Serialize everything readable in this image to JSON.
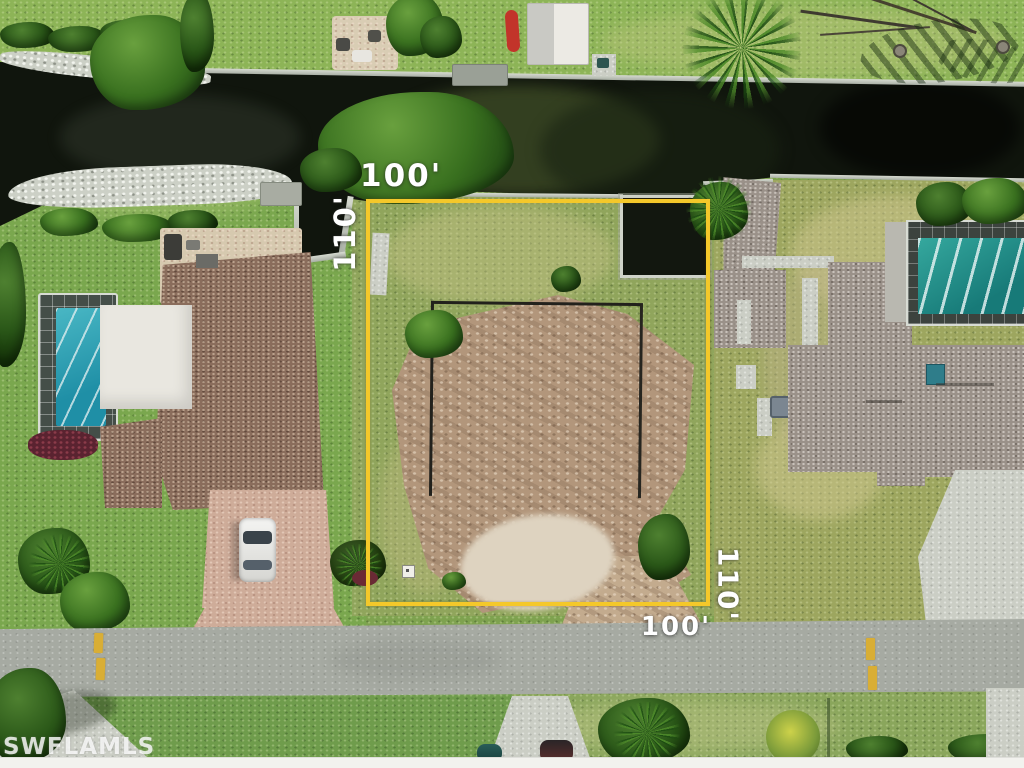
{
  "photo": {
    "type": "aerial-property-listing-photo",
    "watermark": "SWFLAMLS",
    "lot_outline": {
      "label_top": "100'",
      "label_left": "110'",
      "label_right": "110'",
      "label_bottom": "100'"
    },
    "colors": {
      "boundary_yellow": "#F4C82A",
      "canal_water": "#10150D",
      "road_asphalt": "#A6AAA2",
      "grass_green": "#7EA24F",
      "cleared_dirt": "#B2967B",
      "pool_teal": "#2E9E98",
      "label_white": "#FFFFFF"
    }
  }
}
